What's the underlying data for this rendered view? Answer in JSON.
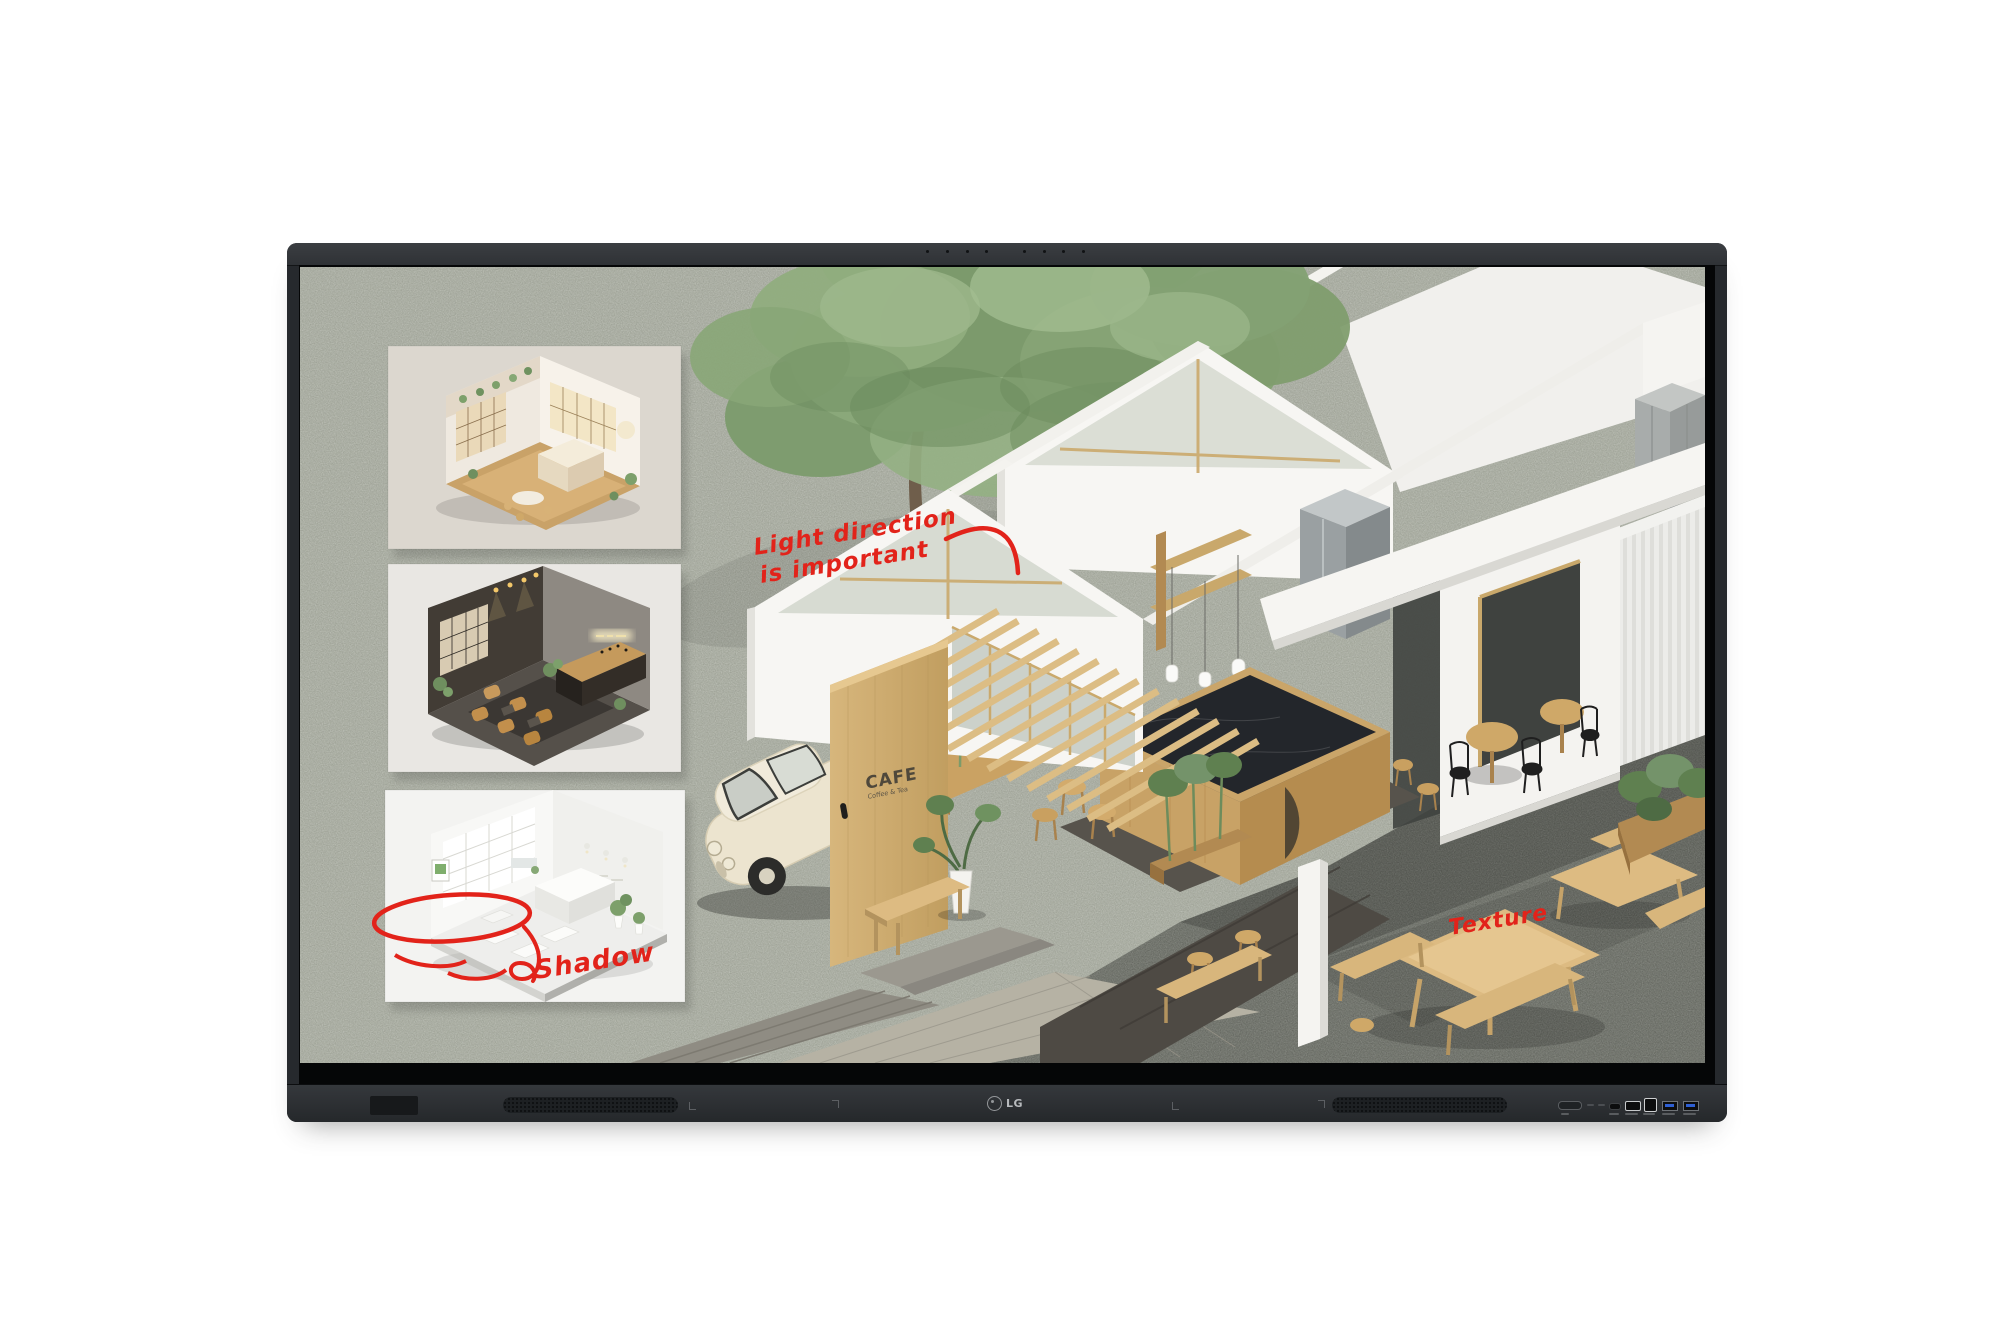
{
  "device": {
    "brand": "LG",
    "screen_annotations": {
      "light_direction_line1": "Light direction",
      "light_direction_line2": "is important",
      "texture_label": "Texture",
      "shadow_label": "Shadow"
    },
    "cafe_sign": {
      "title": "CAFE",
      "subtitle": "Coffee & Tea"
    },
    "colors": {
      "annotation_red": "#e2231a",
      "bezel_dark": "#2c2f33",
      "screen_ground_sage": "#a9ada1",
      "pavement_dark": "#73766f",
      "wood": "#d4b279",
      "usb_port_blue": "#2e5fd3"
    }
  }
}
